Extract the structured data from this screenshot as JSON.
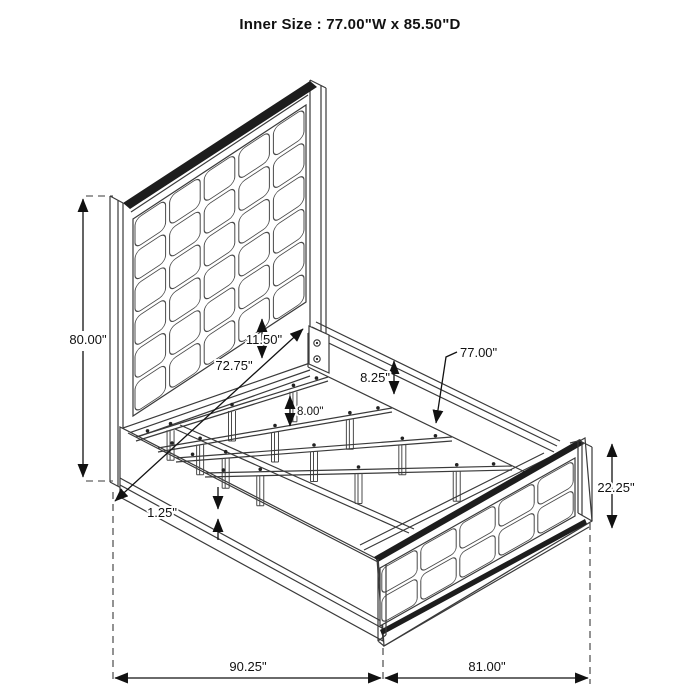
{
  "title": "Inner Size : 77.00\"W x 85.50\"D",
  "diagram_type": "bed-frame-dimension-drawing",
  "colors": {
    "line": "#3a3a3a",
    "text": "#111111",
    "background": "#ffffff"
  },
  "dimensions": {
    "headboard_height": "80.00\"",
    "headboard_width": "72.75\"",
    "panel_to_rail_gap": "11.50\"",
    "side_rail_height": "8.25\"",
    "slat_leg_height": "8.00\"",
    "slat_length": "77.00\"",
    "footboard_height": "22.25\"",
    "rail_lip": "1.25\"",
    "overall_depth": "90.25\"",
    "overall_width": "81.00\""
  }
}
